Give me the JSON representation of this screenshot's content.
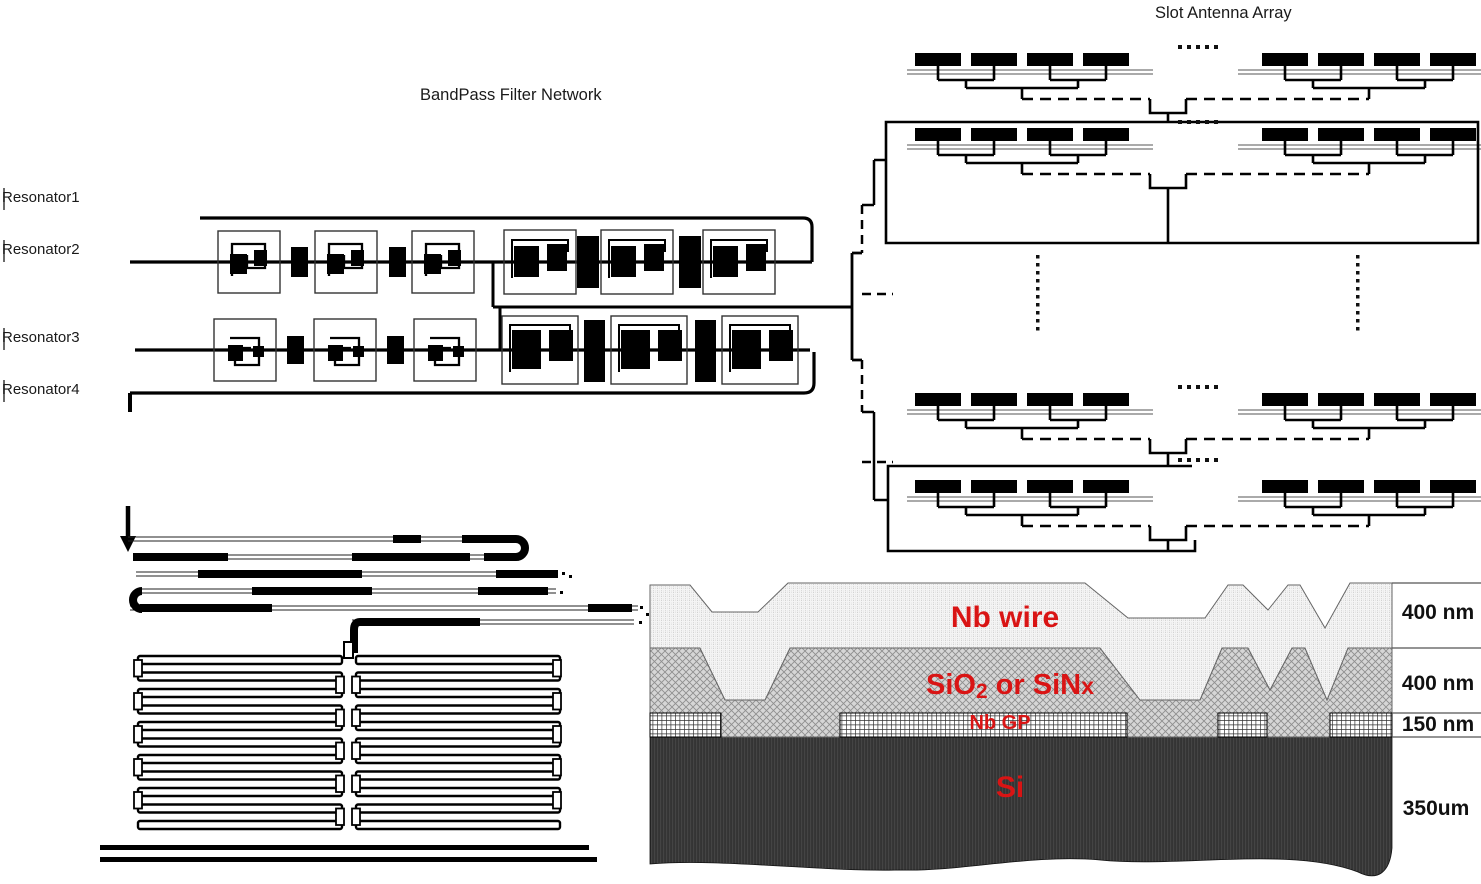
{
  "bandpass_filter": {
    "title": "BandPass Filter Network",
    "resonator_labels": [
      "Resonator1",
      "Resonator2",
      "Resonator3",
      "Resonator4"
    ]
  },
  "antenna_array": {
    "title": "Slot Antenna Array"
  },
  "cross_section": {
    "text_color": "#d91414",
    "layers": [
      {
        "name": "Nb wire",
        "thickness": "400 nm"
      },
      {
        "name": "SiO2 or SiNx",
        "thickness": "400 nm",
        "name_parts": {
          "pre": "SiO",
          "sub": "2",
          "mid": " or SiN",
          "end": "x"
        }
      },
      {
        "name": "Nb GP",
        "thickness": "150 nm"
      },
      {
        "name": "Si",
        "thickness": "350um"
      }
    ]
  }
}
